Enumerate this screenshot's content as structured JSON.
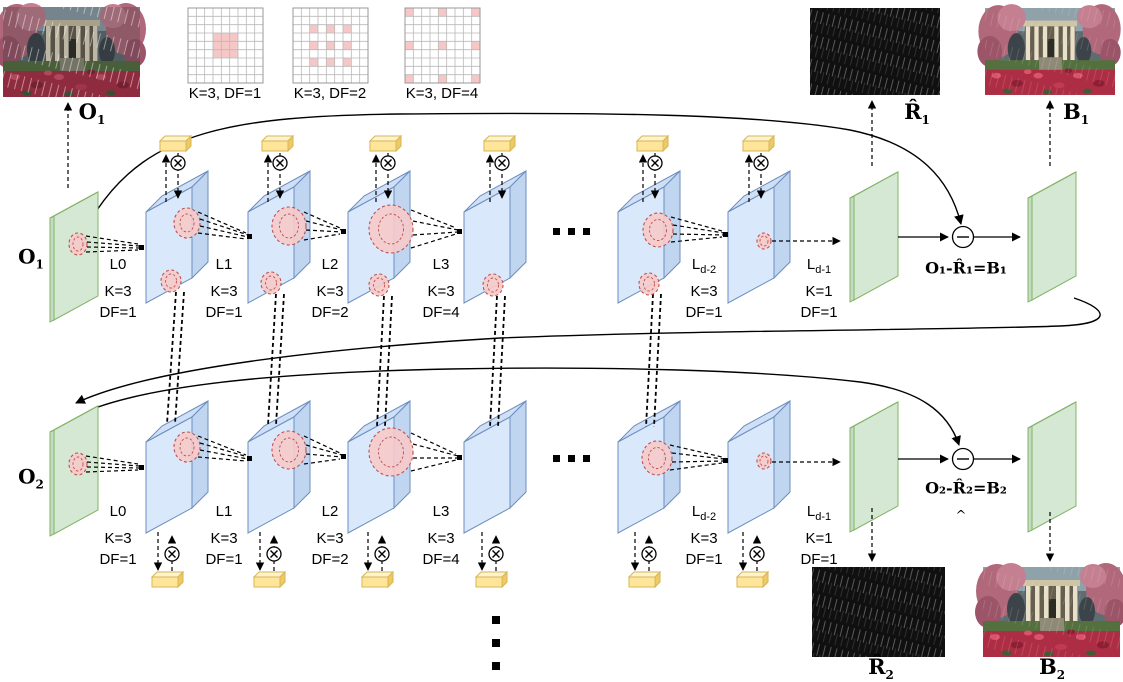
{
  "kernels": [
    {
      "caption": "K=3, DF=1"
    },
    {
      "caption": "K=3, DF=2"
    },
    {
      "caption": "K=3, DF=4"
    }
  ],
  "layers": [
    {
      "name": "L0",
      "sub": "",
      "k": "K=3",
      "df": "DF=1"
    },
    {
      "name": "L1",
      "sub": "",
      "k": "K=3",
      "df": "DF=1"
    },
    {
      "name": "L2",
      "sub": "",
      "k": "K=3",
      "df": "DF=2"
    },
    {
      "name": "L3",
      "sub": "",
      "k": "K=3",
      "df": "DF=4"
    },
    {
      "name": "L",
      "sub": "d-2",
      "k": "K=3",
      "df": "DF=1"
    },
    {
      "name": "L",
      "sub": "d-1",
      "k": "K=1",
      "df": "DF=1"
    }
  ],
  "rows": [
    {
      "input": {
        "base": "O",
        "sub": "1"
      },
      "formula": "O₁-R̂₁=B₁"
    },
    {
      "input": {
        "base": "O",
        "sub": "2"
      },
      "formula": "O₂-R̂₂=B₂",
      "caret": "^"
    }
  ],
  "io": {
    "o1_image": {
      "base": "O",
      "sub": "1"
    },
    "r1_image": {
      "base": "R̂",
      "sub": "1"
    },
    "b1_image": {
      "base": "B",
      "sub": "1"
    },
    "r2_image": {
      "base": "R̂",
      "sub": "2"
    },
    "b2_image": {
      "base": "B",
      "sub": "2"
    }
  },
  "operators": {
    "elementwise_multiply": "⊗",
    "subtract": "⊖"
  },
  "ellipsis": {
    "horizontal": "···",
    "vertical": "⋮"
  },
  "colors": {
    "layer_blue": "#dae8fc",
    "layer_blue_edge": "#6c8ebf",
    "plane_green": "#d5e8d4",
    "plane_green_edge": "#82b366",
    "attention_yellow": "#ffe599",
    "attention_yellow_edge": "#d6b656",
    "receptive_pink": "#f6caca",
    "receptive_pink_edge": "#c0504d",
    "kernel_cell_pink": "#f5c7c7",
    "grid_line": "#b9b9b9"
  }
}
